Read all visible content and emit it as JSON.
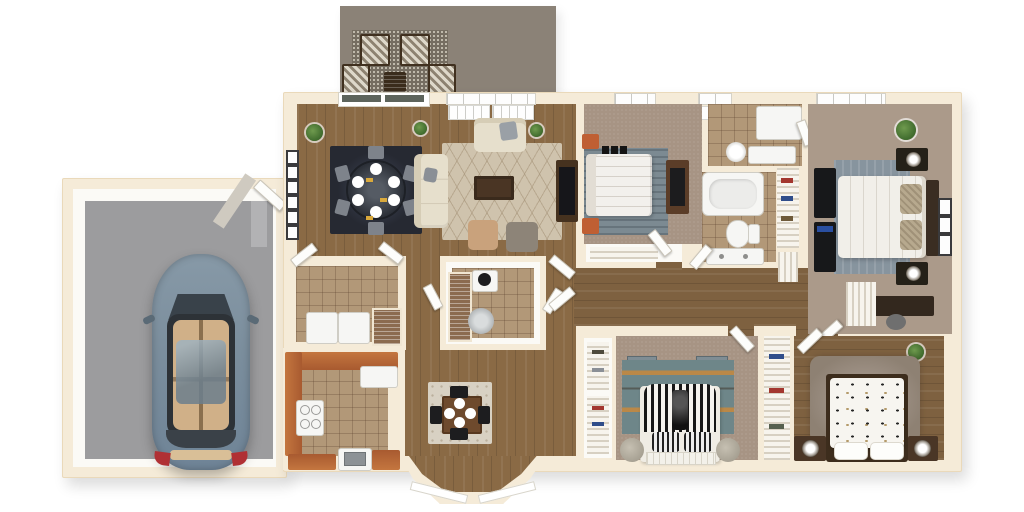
{
  "scene": {
    "kind": "3d-rendered-floor-plan",
    "view": "top-down dollhouse render",
    "visible_text": "none",
    "background": "#ffffff"
  },
  "palette": {
    "exterior_wall_cream": "#f5ebd8",
    "interior_wall_white": "#fbfaf6",
    "hardwood_floor": "#8a6a45",
    "carpet_tan": "#a79484",
    "tile_tan": "#b29878",
    "garage_floor_gray": "#9c9c9e",
    "patio_taupe": "#8b8277",
    "kitchen_counter_terracotta": "#b66a3e",
    "dark_wood_furniture": "#4a3322",
    "black_furniture": "#17181a",
    "cream_upholstery": "#e6dfcc",
    "dining_rug_navy": "#262932",
    "living_rug_beige": "#cfc3ad",
    "bedroom_rug_blue_gray": "#7c8a92",
    "bedroom3_rug_teal": "#6e8689",
    "accent_orange_nightstand": "#bf5f33",
    "car_body_blue_gray": "#7b8e9d",
    "taillight_red": "#b03034"
  },
  "areas": [
    {
      "id": "patio",
      "label": "Patio",
      "floor": "taupe concrete",
      "contents": [
        "speckled outdoor rug",
        "4 armchairs with chevron cushions",
        "slatted wood side table"
      ]
    },
    {
      "id": "dining-area",
      "label": "Dining area",
      "floor": "hardwood",
      "contents": [
        "navy rug",
        "round dark dining table",
        "6 gray chairs",
        "6 white place settings with yellow napkins",
        "potted plant",
        "gallery wall of 6 small frames",
        "sliding glass patio door"
      ]
    },
    {
      "id": "living-room",
      "label": "Living room",
      "floor": "hardwood",
      "contents": [
        "beige diamond-pattern rug",
        "cream sofa",
        "cream loveseat",
        "dark wood coffee table",
        "tan ottoman",
        "gray ottoman",
        "dark media console with TV",
        "2 small plants",
        "ceiling vent grilles"
      ]
    },
    {
      "id": "kitchen",
      "label": "Kitchen",
      "floor": "tan tile",
      "contents": [
        "U-shaped terracotta counters",
        "white range with 4 burners",
        "white refrigerator",
        "white sink cabinet",
        "island cabinet"
      ]
    },
    {
      "id": "breakfast-nook",
      "label": "Breakfast nook",
      "floor": "hardwood",
      "contents": [
        "patterned square rug",
        "square wood table",
        "4 black chairs",
        "4 white plates",
        "bay window"
      ]
    },
    {
      "id": "laundry-room",
      "label": "Laundry room",
      "floor": "tan tile",
      "contents": [
        "washer",
        "dryer",
        "louvered pantry door"
      ]
    },
    {
      "id": "powder-room",
      "label": "Powder room",
      "floor": "tan tile",
      "contents": [
        "toilet",
        "pedestal sink",
        "louvered utility closet"
      ]
    },
    {
      "id": "bedroom-2",
      "label": "Bedroom 2 (top)",
      "floor": "tan carpet",
      "contents": [
        "white bed on blue-gray rug",
        "2 orange nightstands",
        "wood dresser with TV",
        "wire-shelf closet",
        "ceiling vent"
      ]
    },
    {
      "id": "master-bathroom",
      "label": "Bathroom (top)",
      "floor": "tan tile",
      "contents": [
        "round white sink",
        "vanity counter",
        "shower area"
      ]
    },
    {
      "id": "hall-bathroom",
      "label": "Hall bathroom",
      "floor": "tan tile",
      "contents": [
        "bathtub",
        "toilet",
        "vanity with faucets",
        "wire-shelf linen closet with clothes"
      ]
    },
    {
      "id": "master-bedroom",
      "label": "Master bedroom",
      "floor": "tan carpet",
      "contents": [
        "white bed with tan pillows and dark headboard",
        "blue-gray rug",
        "black double dresser",
        "2 dark nightstands with lamps",
        "desk with chair",
        "3 wall frames",
        "potted plant",
        "walk-in wire-shelf closet",
        "ceiling vents"
      ]
    },
    {
      "id": "bedroom-3",
      "label": "Bedroom 3 (bottom left)",
      "floor": "tan carpet",
      "contents": [
        "black-and-white striped draped bed",
        "striped pillows",
        "teal rug with orange stripes",
        "2 gray poufs",
        "2 leaning art panels",
        "double wire-shelf closet with clothes"
      ]
    },
    {
      "id": "bedroom-4",
      "label": "Bedroom 4 (bottom right)",
      "floor": "hardwood",
      "contents": [
        "bed with polka-dot duvet",
        "dark wood bed frame",
        "2 dark nightstands with round lamps",
        "shaggy gray-brown rug",
        "small plant",
        "wire-shelf closet with clothes"
      ]
    },
    {
      "id": "hallway",
      "label": "Hallway",
      "floor": "hardwood",
      "contents": [
        "white interior doors",
        "linen closets with wire shelving"
      ]
    },
    {
      "id": "garage",
      "label": "Garage",
      "floor": "gray concrete",
      "contents": [
        "blue-gray sedan (top view)",
        "driveway seam strip"
      ]
    },
    {
      "id": "entry",
      "label": "Front entry",
      "floor": "walkway",
      "contents": [
        "open white front door",
        "porch path"
      ]
    }
  ],
  "vehicle": {
    "type": "sedan",
    "body_color": "#7b8e9d",
    "roof": "dark glass with tan interior visible",
    "taillights": "red",
    "orientation": "parked vertically, nose up"
  }
}
